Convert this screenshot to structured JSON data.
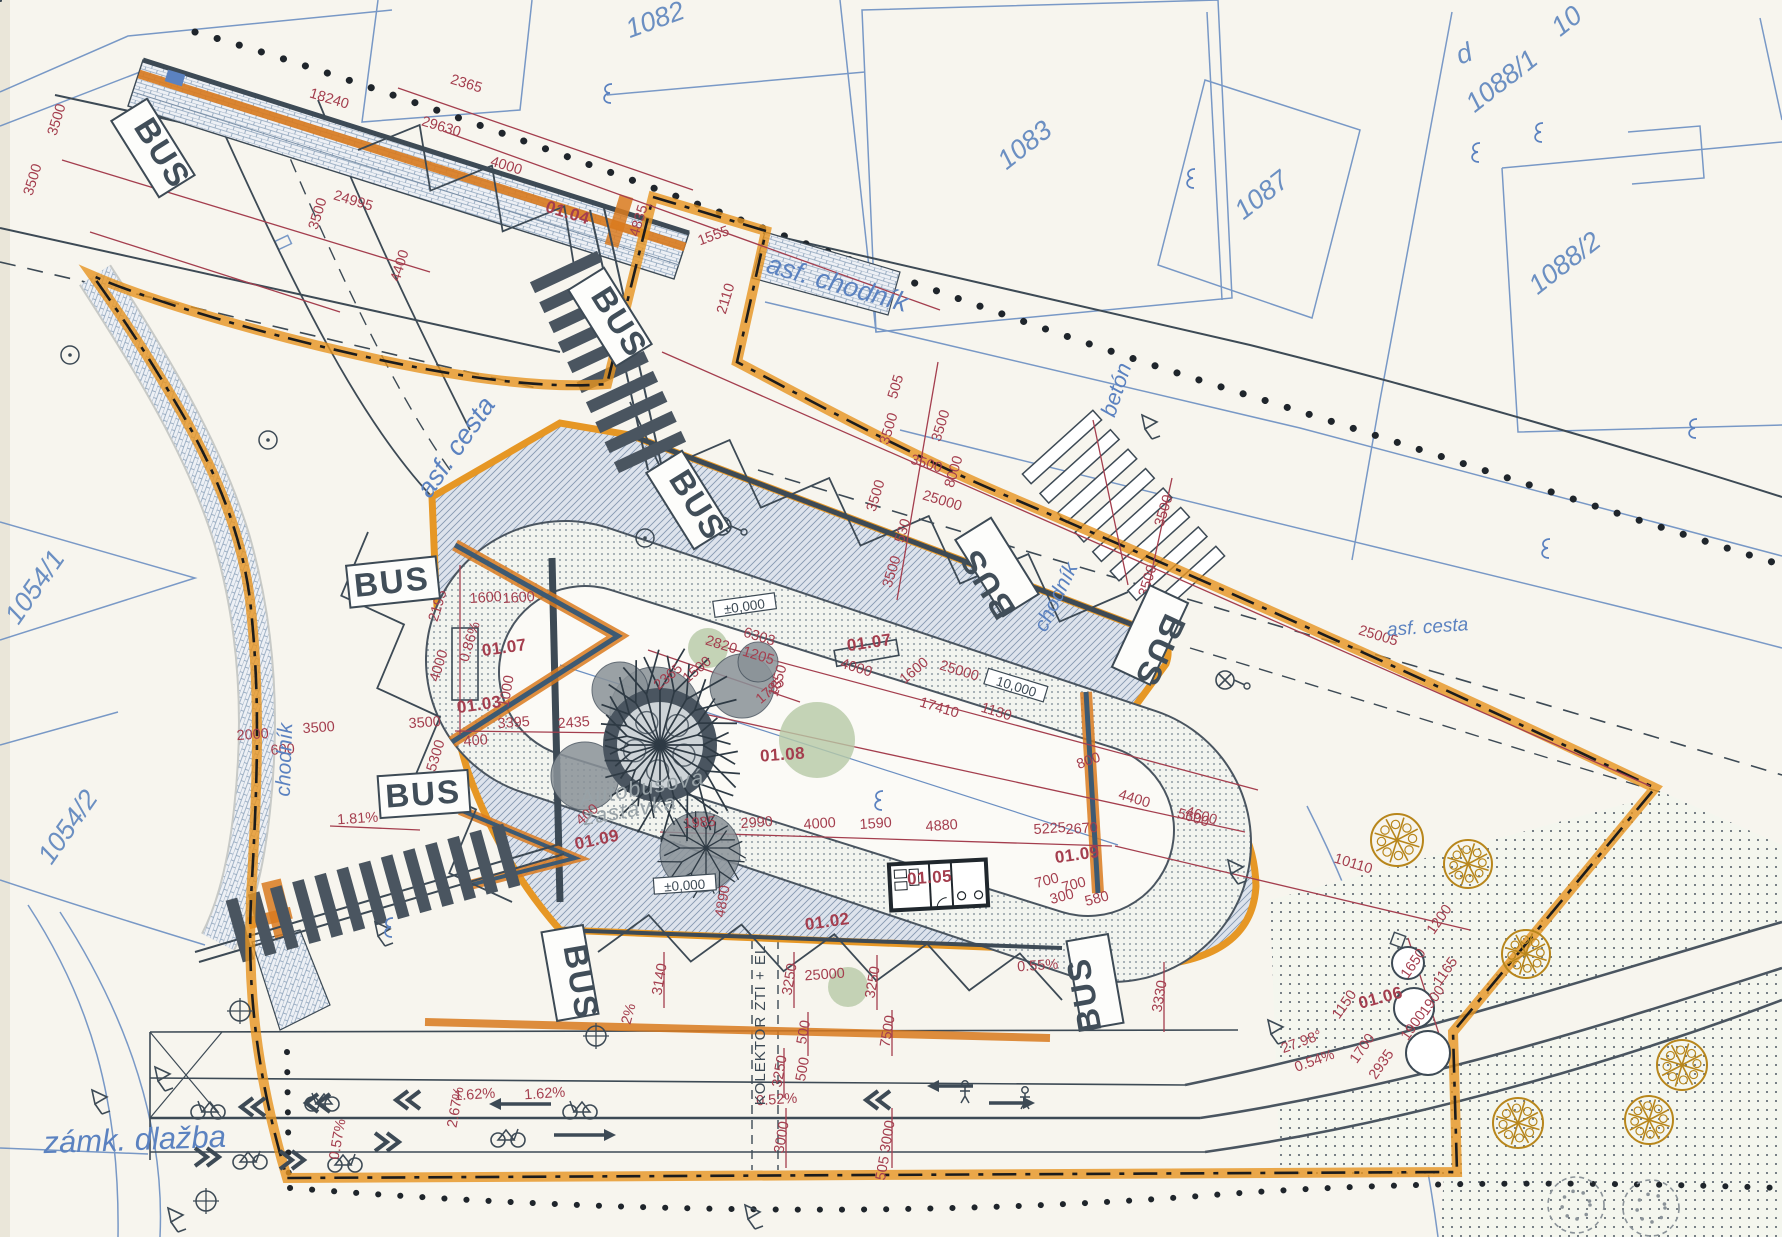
{
  "title": "Autobusová zastávka – situačný výkres (bus stop site plan)",
  "colors": {
    "paper": "#f7f5ee",
    "cadastre_blue": "#5b82c0",
    "dimension_red": "#a43e4e",
    "line_dark": "#3d4a55",
    "boundary_orange": "#e6941f",
    "tree_orange": "#b8861b",
    "green_area": "#b7c9a6",
    "note_gray": "#98a2a7"
  },
  "bus_label": "BUS",
  "note": {
    "line1": "Autobusová",
    "line2": "zastávka",
    "x": 643,
    "y": 795,
    "r": -10
  },
  "kolektor": {
    "text": "KOLEKTOR ZTI + EL",
    "x": 765,
    "y": 1025,
    "r": -90
  },
  "streets": [
    {
      "id": "asf-chodnik",
      "text": "asf. chodník",
      "x": 835,
      "y": 292,
      "r": 16,
      "s": 27
    },
    {
      "id": "beton",
      "text": "betón",
      "x": 1123,
      "y": 392,
      "r": -72,
      "s": 22
    },
    {
      "id": "asf-cesta-west",
      "text": "asf. cesta",
      "x": 463,
      "y": 452,
      "r": -55,
      "s": 27
    },
    {
      "id": "asf-cesta-east",
      "text": "asf. cesta",
      "x": 1428,
      "y": 633,
      "r": -4,
      "s": 19
    },
    {
      "id": "chodnik-west",
      "text": "chodník",
      "x": 291,
      "y": 760,
      "r": -88,
      "s": 21
    },
    {
      "id": "chodnik-mid",
      "text": "chodník",
      "x": 1062,
      "y": 600,
      "r": -64,
      "s": 21
    },
    {
      "id": "zamk-dlazba",
      "text": "zámk. dlažba",
      "x": 135,
      "y": 1150,
      "r": -2,
      "s": 31
    }
  ],
  "parcels": [
    {
      "text": "1082",
      "x": 658,
      "y": 28,
      "r": -20
    },
    {
      "text": "1083",
      "x": 1030,
      "y": 152,
      "r": -38
    },
    {
      "text": "1087",
      "x": 1267,
      "y": 202,
      "r": -38
    },
    {
      "text": "1088/1",
      "x": 1507,
      "y": 88,
      "r": -38
    },
    {
      "text": "1088/2",
      "x": 1570,
      "y": 270,
      "r": -38
    },
    {
      "text": "1054/1",
      "x": 42,
      "y": 592,
      "r": -55
    },
    {
      "text": "1054/2",
      "x": 75,
      "y": 832,
      "r": -55
    },
    {
      "text": "10",
      "x": 1572,
      "y": 28,
      "r": -38
    },
    {
      "text": "d",
      "x": 1467,
      "y": 62,
      "r": -20
    }
  ],
  "bus_stops": [
    {
      "x": 153,
      "y": 148,
      "r": 58
    },
    {
      "x": 610,
      "y": 317,
      "r": 58
    },
    {
      "x": 688,
      "y": 500,
      "r": 58
    },
    {
      "x": 997,
      "y": 567,
      "r": -122
    },
    {
      "x": 1150,
      "y": 635,
      "r": 115
    },
    {
      "x": 393,
      "y": 582,
      "r": -6
    },
    {
      "x": 424,
      "y": 794,
      "r": -4
    },
    {
      "x": 570,
      "y": 973,
      "r": 80
    },
    {
      "x": 1095,
      "y": 982,
      "r": -100
    }
  ],
  "refs": [
    {
      "text": "01.04",
      "x": 566,
      "y": 218,
      "r": 17
    },
    {
      "text": "01.07",
      "x": 505,
      "y": 653,
      "r": -8
    },
    {
      "text": "01.07",
      "x": 870,
      "y": 648,
      "r": -8
    },
    {
      "text": "01.03",
      "x": 480,
      "y": 710,
      "r": -8
    },
    {
      "text": "01.08",
      "x": 783,
      "y": 760,
      "r": -4
    },
    {
      "text": "01.09",
      "x": 598,
      "y": 845,
      "r": -12
    },
    {
      "text": "01.09",
      "x": 1078,
      "y": 860,
      "r": -8
    },
    {
      "text": "01.05",
      "x": 930,
      "y": 883,
      "r": -4
    },
    {
      "text": "01.02",
      "x": 828,
      "y": 927,
      "r": -8
    },
    {
      "text": "01.06",
      "x": 1382,
      "y": 1003,
      "r": -15
    }
  ],
  "boxed_marks": [
    {
      "text": "±0,000",
      "x": 745,
      "y": 608,
      "r": -8
    },
    {
      "text": "±0,000",
      "x": 685,
      "y": 887,
      "r": -4
    },
    {
      "text": "10,000",
      "x": 1015,
      "y": 688,
      "r": 17
    }
  ],
  "dimensions": [
    [
      "2365",
      465,
      88,
      17
    ],
    [
      "18240",
      328,
      103,
      17
    ],
    [
      "29630",
      440,
      131,
      17
    ],
    [
      "4000",
      505,
      170,
      17
    ],
    [
      "24995",
      352,
      205,
      17
    ],
    [
      "3500",
      322,
      215,
      -73
    ],
    [
      "3500",
      61,
      121,
      -73
    ],
    [
      "3500",
      37,
      181,
      -73
    ],
    [
      "4400",
      404,
      267,
      -73
    ],
    [
      "4835",
      643,
      222,
      -73
    ],
    [
      "1555",
      715,
      240,
      -20
    ],
    [
      "2110",
      730,
      300,
      -73
    ],
    [
      "505",
      900,
      388,
      -73
    ],
    [
      "3500",
      893,
      430,
      -73
    ],
    [
      "8000",
      958,
      473,
      -73
    ],
    [
      "3500",
      880,
      497,
      -73
    ],
    [
      "530",
      907,
      532,
      -73
    ],
    [
      "3500",
      896,
      573,
      -73
    ],
    [
      "25000",
      941,
      505,
      17
    ],
    [
      "3500",
      925,
      468,
      17
    ],
    [
      "3500",
      1168,
      512,
      -73
    ],
    [
      "3500",
      1152,
      582,
      -73
    ],
    [
      "25005",
      1377,
      640,
      17
    ],
    [
      "3500",
      945,
      427,
      -73
    ],
    [
      "6303",
      758,
      641,
      17
    ],
    [
      "2820",
      720,
      649,
      17
    ],
    [
      "1205",
      757,
      660,
      17
    ],
    [
      "1500",
      700,
      673,
      -40
    ],
    [
      "2365",
      671,
      680,
      -40
    ],
    [
      "1850",
      782,
      682,
      -73
    ],
    [
      "1785",
      773,
      694,
      -40
    ],
    [
      "1600",
      486,
      602,
      -4
    ],
    [
      "1600",
      519,
      602,
      -4
    ],
    [
      "1000",
      511,
      692,
      -80
    ],
    [
      "2195",
      442,
      607,
      -73
    ],
    [
      "4000",
      443,
      667,
      -73
    ],
    [
      "3500",
      425,
      727,
      -4
    ],
    [
      "5300",
      440,
      757,
      -73
    ],
    [
      "3500",
      319,
      732,
      -4
    ],
    [
      "2000",
      253,
      739,
      -4
    ],
    [
      "600",
      283,
      754,
      -4
    ],
    [
      "0.86%",
      474,
      643,
      -73
    ],
    [
      "1.81%",
      358,
      823,
      -4
    ],
    [
      "3395",
      514,
      727,
      -4
    ],
    [
      "2435",
      574,
      727,
      -4
    ],
    [
      "400",
      476,
      745,
      -4
    ],
    [
      "400",
      590,
      818,
      -40
    ],
    [
      "1985",
      700,
      827,
      -4
    ],
    [
      "2990",
      757,
      827,
      -4
    ],
    [
      "4000",
      820,
      828,
      -4
    ],
    [
      "1590",
      876,
      828,
      -4
    ],
    [
      "4880",
      942,
      830,
      -4
    ],
    [
      "5225",
      1050,
      833,
      -4
    ],
    [
      "2670",
      1082,
      833,
      -4
    ],
    [
      "17410",
      938,
      712,
      17
    ],
    [
      "25000",
      958,
      675,
      17
    ],
    [
      "1130",
      995,
      716,
      17
    ],
    [
      "800",
      1090,
      765,
      -20
    ],
    [
      "4400",
      1133,
      803,
      17
    ],
    [
      "4600",
      1200,
      820,
      17
    ],
    [
      "10110",
      1352,
      868,
      17
    ],
    [
      "4000",
      855,
      672,
      17
    ],
    [
      "1600",
      917,
      674,
      -40
    ],
    [
      "5600",
      1192,
      822,
      17
    ],
    [
      "4890",
      727,
      902,
      -80
    ],
    [
      "700",
      1048,
      885,
      -15
    ],
    [
      "700",
      1075,
      889,
      -15
    ],
    [
      "300",
      1063,
      901,
      -15
    ],
    [
      "580",
      1098,
      903,
      -15
    ],
    [
      "2%",
      633,
      1015,
      -75
    ],
    [
      "3140",
      664,
      980,
      -80
    ],
    [
      "3250",
      794,
      980,
      -80
    ],
    [
      "3250",
      877,
      983,
      -80
    ],
    [
      "25000",
      825,
      979,
      -4
    ],
    [
      "500",
      808,
      1033,
      -80
    ],
    [
      "7500",
      892,
      1032,
      -80
    ],
    [
      "3250",
      784,
      1072,
      -80
    ],
    [
      "500",
      807,
      1070,
      -80
    ],
    [
      "0.52%",
      777,
      1104,
      -4
    ],
    [
      "3000",
      786,
      1138,
      -80
    ],
    [
      "3000",
      892,
      1137,
      -80
    ],
    [
      "505",
      887,
      1169,
      -80
    ],
    [
      "1.62%",
      475,
      1099,
      -4
    ],
    [
      "1.62%",
      545,
      1098,
      -4
    ],
    [
      "2.67%",
      460,
      1108,
      -80
    ],
    [
      "0.57%",
      342,
      1140,
      -80
    ],
    [
      "3330",
      1164,
      997,
      -80
    ],
    [
      "0.55%",
      1038,
      970,
      -4
    ],
    [
      "1200",
      1443,
      922,
      -55
    ],
    [
      "1650",
      1417,
      966,
      -55
    ],
    [
      "1165",
      1449,
      974,
      -55
    ],
    [
      "1900",
      1436,
      1003,
      -55
    ],
    [
      "1900",
      1417,
      1028,
      -55
    ],
    [
      "1700",
      1366,
      1051,
      -55
    ],
    [
      "1150",
      1348,
      1007,
      -55
    ],
    [
      "2935",
      1385,
      1067,
      -55
    ],
    [
      "27.98°",
      1303,
      1046,
      -20
    ],
    [
      "0.54%",
      1316,
      1065,
      -20
    ]
  ],
  "dim_lines": [
    [
      398,
      88,
      693,
      190
    ],
    [
      443,
      131,
      940,
      310
    ],
    [
      62,
      160,
      430,
      272
    ],
    [
      90,
      232,
      340,
      312
    ],
    [
      938,
      362,
      897,
      600
    ],
    [
      1172,
      478,
      1143,
      612
    ],
    [
      662,
      352,
      1650,
      786
    ],
    [
      660,
      832,
      1112,
      846
    ],
    [
      1115,
      846,
      1470,
      930
    ],
    [
      640,
      700,
      1245,
      832
    ],
    [
      705,
      642,
      1258,
      790
    ],
    [
      455,
      731,
      620,
      733
    ],
    [
      648,
      650,
      800,
      702
    ],
    [
      330,
      826,
      420,
      830
    ],
    [
      460,
      565,
      460,
      735
    ],
    [
      664,
      952,
      664,
      1008
    ],
    [
      794,
      952,
      794,
      1008
    ],
    [
      877,
      955,
      877,
      1010
    ],
    [
      808,
      1012,
      808,
      1056
    ],
    [
      892,
      1010,
      892,
      1056
    ],
    [
      784,
      1048,
      784,
      1098
    ],
    [
      786,
      1108,
      786,
      1168
    ],
    [
      892,
      1108,
      892,
      1168
    ],
    [
      1164,
      962,
      1164,
      1032
    ],
    [
      1408,
      938,
      1448,
      1062
    ],
    [
      1093,
      420,
      1128,
      585
    ]
  ],
  "trees": {
    "solid": [
      [
        1397,
        840,
        26
      ],
      [
        1468,
        864,
        24
      ],
      [
        1526,
        954,
        24
      ],
      [
        1682,
        1065,
        25
      ],
      [
        1649,
        1120,
        24
      ],
      [
        1518,
        1123,
        25
      ]
    ],
    "dashed": [
      [
        1576,
        1205,
        28
      ],
      [
        1651,
        1208,
        28
      ]
    ],
    "island_dashed": [
      [
        1107,
        807,
        24
      ]
    ]
  },
  "green_areas": [
    [
      817,
      740,
      38
    ],
    [
      708,
      648,
      20
    ],
    [
      848,
      987,
      20
    ]
  ],
  "manholes": [
    [
      1408,
      963,
      16
    ],
    [
      1414,
      1008,
      20
    ],
    [
      1428,
      1053,
      22
    ]
  ],
  "icons": [
    {
      "type": "bicycle",
      "x": 208,
      "y": 1108,
      "dir": -1
    },
    {
      "type": "bicycle",
      "x": 322,
      "y": 1100,
      "dir": -1
    },
    {
      "type": "bicycle",
      "x": 580,
      "y": 1108,
      "dir": -1
    },
    {
      "type": "bicycle",
      "x": 508,
      "y": 1136,
      "dir": 1
    },
    {
      "type": "bicycle",
      "x": 250,
      "y": 1158,
      "dir": 1
    },
    {
      "type": "bicycle",
      "x": 345,
      "y": 1161,
      "dir": 1
    },
    {
      "type": "person",
      "x": 965,
      "y": 1092
    },
    {
      "type": "person",
      "x": 1025,
      "y": 1098
    },
    {
      "type": "chevron-left",
      "x": 400,
      "y": 1100
    },
    {
      "type": "chevron-left",
      "x": 245,
      "y": 1107
    },
    {
      "type": "chevron-left",
      "x": 310,
      "y": 1103
    },
    {
      "type": "chevron-left",
      "x": 870,
      "y": 1100
    },
    {
      "type": "chevron-right",
      "x": 395,
      "y": 1142
    },
    {
      "type": "chevron-right",
      "x": 215,
      "y": 1157
    },
    {
      "type": "chevron-right",
      "x": 300,
      "y": 1160
    },
    {
      "type": "arrow-left",
      "x": 520,
      "y": 1104,
      "len": 62
    },
    {
      "type": "arrow-right",
      "x": 585,
      "y": 1135,
      "len": 62
    },
    {
      "type": "arrow-left",
      "x": 950,
      "y": 1086,
      "len": 46
    },
    {
      "type": "arrow-right",
      "x": 1012,
      "y": 1103,
      "len": 46
    },
    {
      "type": "lamp",
      "x": 722,
      "y": 526
    },
    {
      "type": "lamp",
      "x": 1225,
      "y": 680
    },
    {
      "type": "circle-dot",
      "x": 645,
      "y": 538
    },
    {
      "type": "circle-dot",
      "x": 70,
      "y": 355
    },
    {
      "type": "circle-dot",
      "x": 268,
      "y": 440
    },
    {
      "type": "circle-cross",
      "x": 240,
      "y": 1011
    },
    {
      "type": "circle-cross",
      "x": 206,
      "y": 1201
    },
    {
      "type": "circle-cross",
      "x": 596,
      "y": 1036
    },
    {
      "type": "marker",
      "x": 375,
      "y": 922
    },
    {
      "type": "marker",
      "x": 92,
      "y": 1090
    },
    {
      "type": "marker",
      "x": 155,
      "y": 1067
    },
    {
      "type": "marker",
      "x": 168,
      "y": 1208
    },
    {
      "type": "marker",
      "x": 1142,
      "y": 415
    },
    {
      "type": "marker",
      "x": 745,
      "y": 1205
    },
    {
      "type": "marker",
      "x": 1228,
      "y": 860
    },
    {
      "type": "marker",
      "x": 1268,
      "y": 1020
    },
    {
      "type": "squiggle",
      "x": 607,
      "y": 93
    },
    {
      "type": "squiggle",
      "x": 1190,
      "y": 178
    },
    {
      "type": "squiggle",
      "x": 1545,
      "y": 548
    },
    {
      "type": "squiggle",
      "x": 878,
      "y": 800
    },
    {
      "type": "squiggle",
      "x": 388,
      "y": 927
    },
    {
      "type": "squiggle",
      "x": 1692,
      "y": 428
    },
    {
      "type": "squiggle",
      "x": 1475,
      "y": 152
    },
    {
      "type": "squiggle",
      "x": 1538,
      "y": 132
    }
  ]
}
